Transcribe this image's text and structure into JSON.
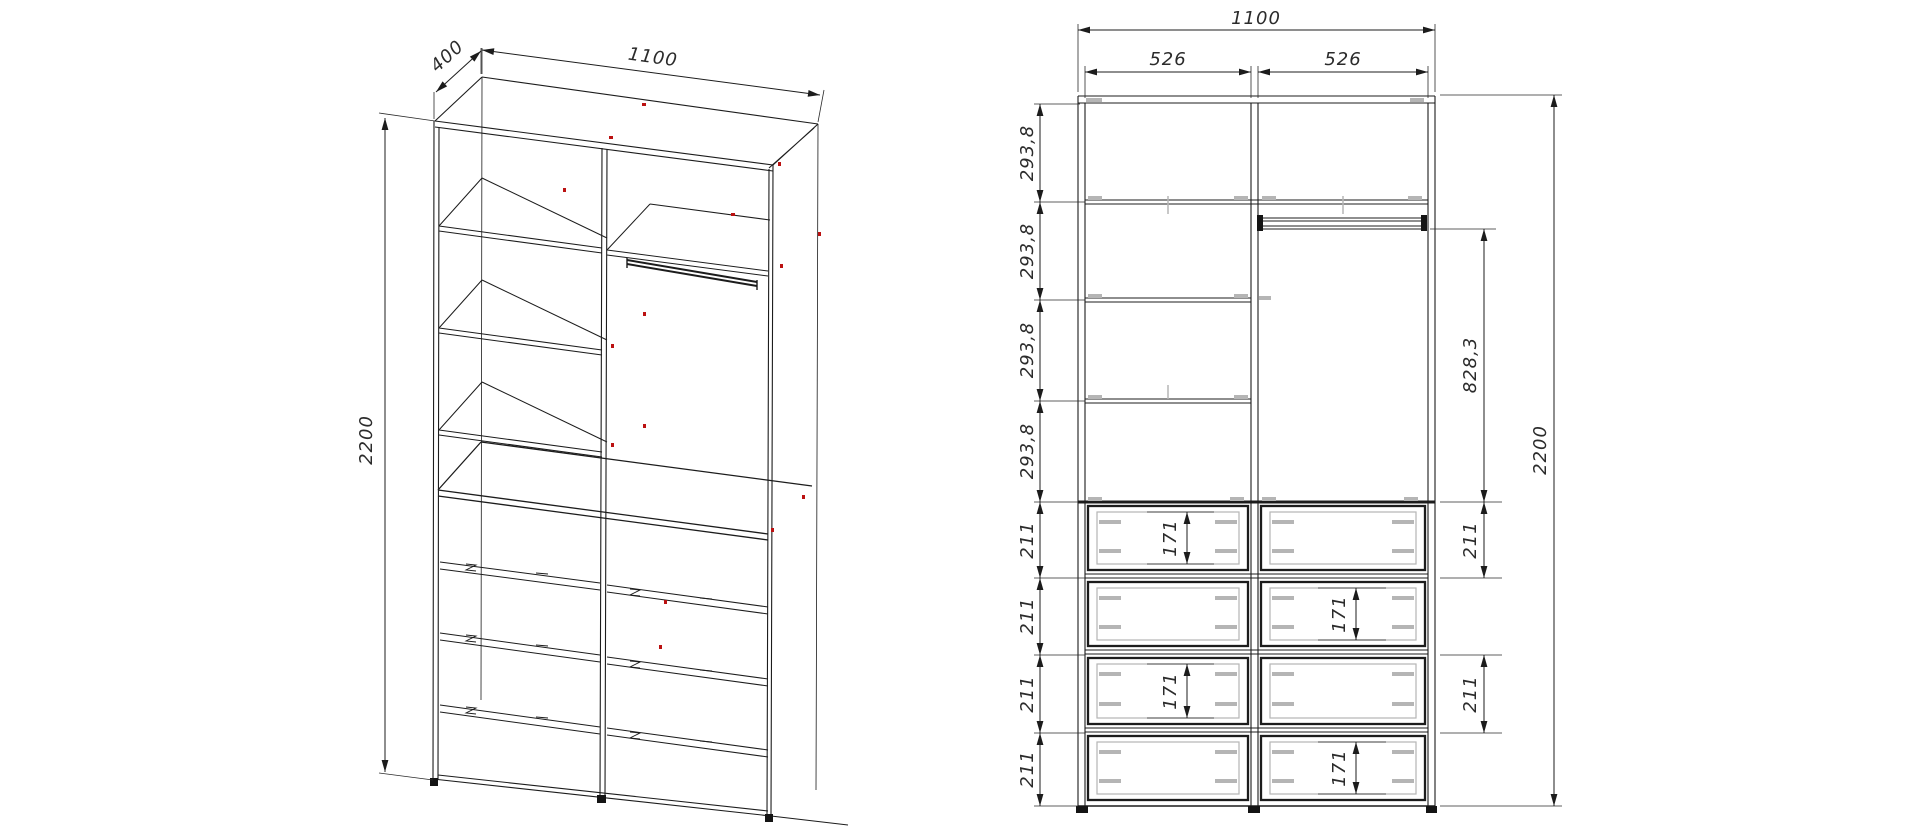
{
  "drawing": {
    "type": "furniture_cad_drawing",
    "views": {
      "iso": {
        "dims": {
          "depth": "400",
          "width": "1100",
          "height": "2200"
        }
      },
      "front": {
        "dims": {
          "width_total": "1100",
          "opening_left": "526",
          "opening_right": "526",
          "left_chain": [
            "293,8",
            "293,8",
            "293,8",
            "293,8",
            "211",
            "211",
            "211",
            "211"
          ],
          "drawer_front_heights": [
            "171",
            "171",
            "171",
            "171"
          ],
          "rod_to_drawer": "828,3",
          "right_chain": [
            "211",
            "211"
          ],
          "height_total": "2200"
        }
      }
    },
    "colors": {
      "line": "#1c1c1c",
      "dim_line": "#2b2b2b",
      "hardware_gray": "#b5b5b5",
      "marker_red": "#bb1111"
    }
  }
}
